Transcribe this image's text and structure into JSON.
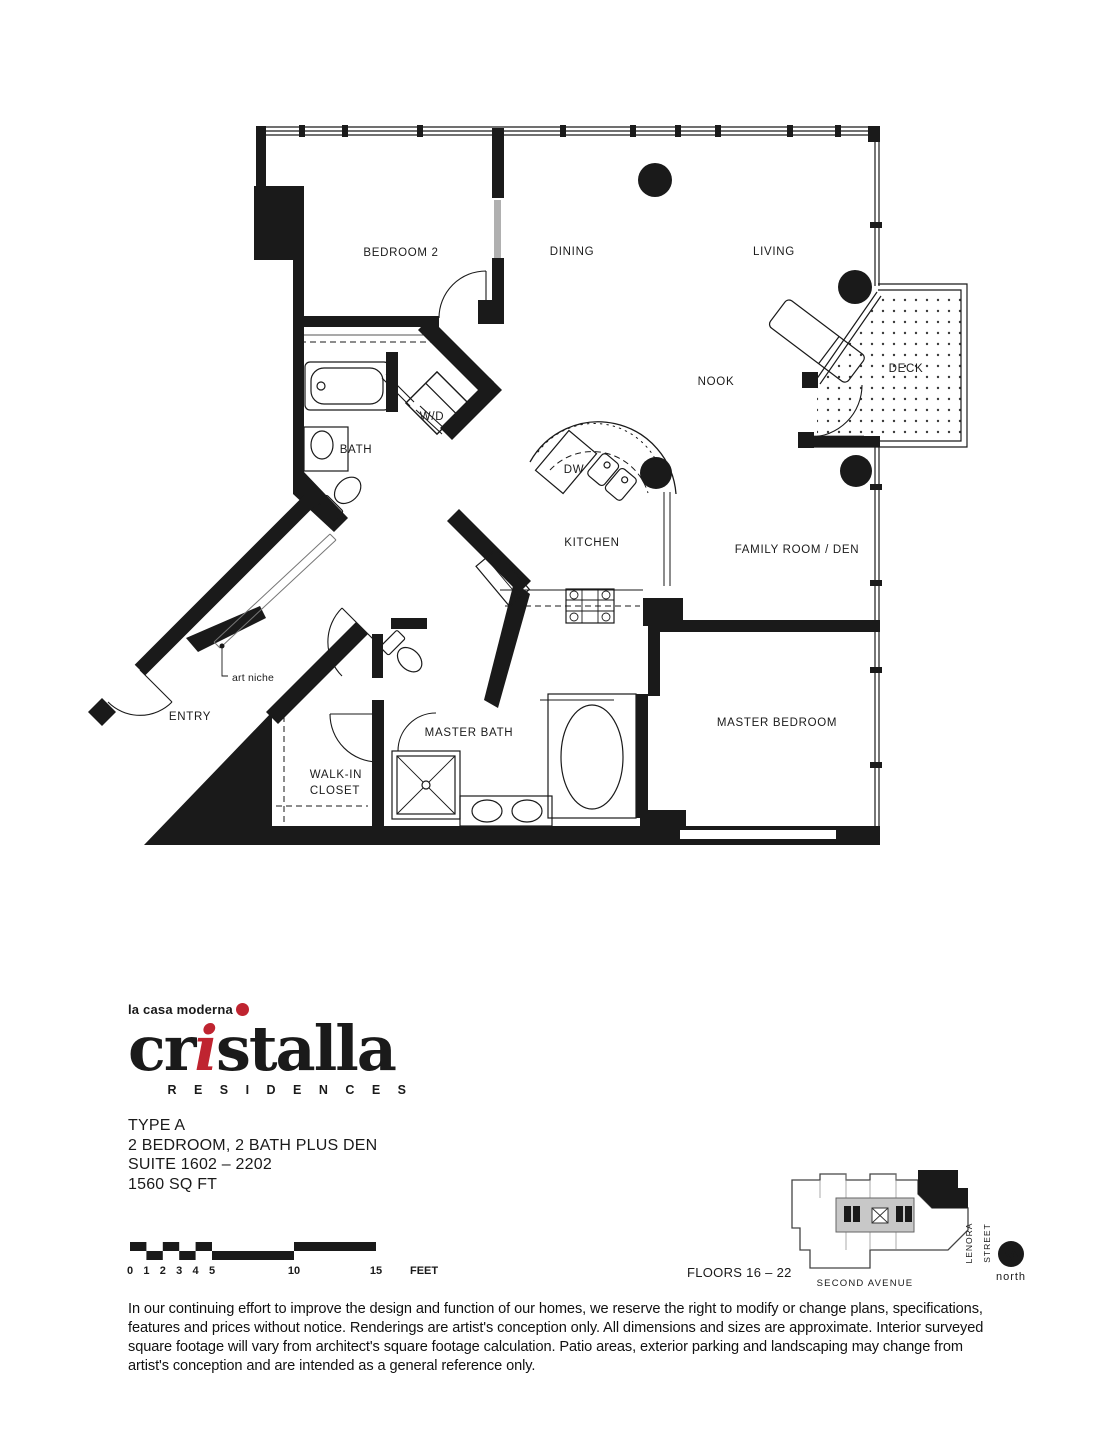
{
  "brand": {
    "tagline": "la casa moderna",
    "name_pre": "cr",
    "name_accent": "i",
    "name_post": "stalla",
    "residences": "R E S I D E N C E S",
    "accent_color": "#bf2430"
  },
  "unit": {
    "type_label": "TYPE A",
    "bedrooms": "2 BEDROOM, 2 BATH PLUS DEN",
    "suite": "SUITE 1602 – 2202",
    "area": "1560 SQ FT"
  },
  "plan": {
    "rooms": [
      {
        "id": "bedroom2",
        "label": "BEDROOM 2"
      },
      {
        "id": "dining",
        "label": "DINING"
      },
      {
        "id": "living",
        "label": "LIVING"
      },
      {
        "id": "nook",
        "label": "NOOK"
      },
      {
        "id": "deck",
        "label": "DECK"
      },
      {
        "id": "bath",
        "label": "BATH"
      },
      {
        "id": "wd",
        "label": "W/D"
      },
      {
        "id": "dw",
        "label": "DW"
      },
      {
        "id": "kitchen",
        "label": "KITCHEN"
      },
      {
        "id": "family",
        "label": "FAMILY ROOM / DEN"
      },
      {
        "id": "entry",
        "label": "ENTRY"
      },
      {
        "id": "wic-line1",
        "label": "WALK-IN"
      },
      {
        "id": "wic-line2",
        "label": "CLOSET"
      },
      {
        "id": "masterbath",
        "label": "MASTER BATH"
      },
      {
        "id": "masterbed",
        "label": "MASTER BEDROOM"
      },
      {
        "id": "artniche",
        "label": "art niche"
      }
    ]
  },
  "scale_bar": {
    "ticks": [
      "0",
      "1",
      "2",
      "3",
      "4",
      "5",
      "10",
      "15"
    ],
    "unit_label": "FEET"
  },
  "key_plan": {
    "floors_label": "FLOORS 16 – 22",
    "avenue_label": "SECOND AVENUE",
    "street_label_1": "LENORA",
    "street_label_2": "STREET",
    "north_label": "north"
  },
  "disclaimer": {
    "line1": "In our continuing effort to improve the design and function of our homes, we reserve the right to modify or change plans, specifications,",
    "line2": "features and prices without notice. Renderings are artist's conception only. All dimensions and sizes are approximate. Interior surveyed",
    "line3": "square footage will vary from architect's square footage calculation. Patio areas, exterior parking and landscaping may change from",
    "line4": "artist's conception and are intended as a general reference only."
  }
}
